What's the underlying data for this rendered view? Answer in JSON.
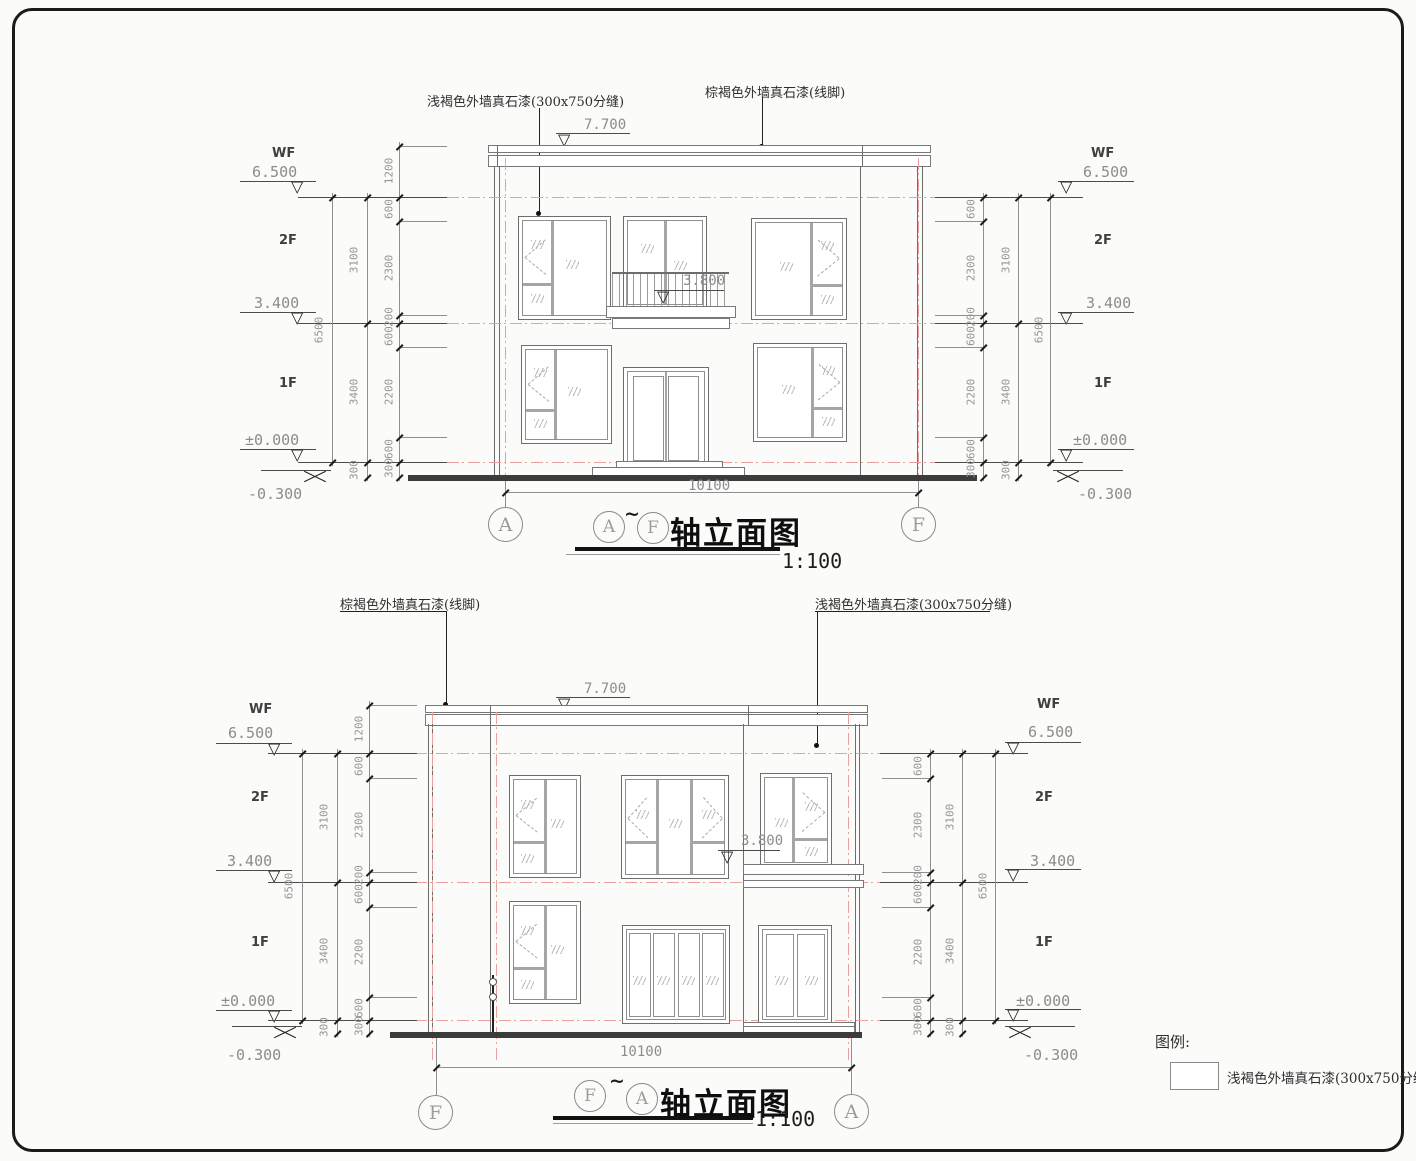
{
  "annotations": {
    "paint_light": "浅褐色外墙真石漆(300x750分缝)",
    "paint_dark": "棕褐色外墙真石漆(线脚)"
  },
  "levels": {
    "l77": "7.700",
    "l65": "6.500",
    "l38": "3.800",
    "l34": "3.400",
    "l00": "±0.000",
    "lm03": "-0.300"
  },
  "floors": {
    "wf": "WF",
    "f2": "2F",
    "f1": "1F"
  },
  "dims": {
    "d10100": "10100",
    "d1200": "1200",
    "d600": "600",
    "d2300": "2300",
    "d200": "200",
    "d2200": "2200",
    "d300": "300",
    "d3100": "3100",
    "d3400": "3400",
    "d6500": "6500"
  },
  "titles": {
    "top": {
      "left_axis": "A",
      "right_axis": "F",
      "t1": "A",
      "tilde": "~",
      "t2": "F",
      "name": "轴立面图",
      "scale": "1:100"
    },
    "bottom": {
      "left_axis": "F",
      "right_axis": "A",
      "t1": "F",
      "tilde": "~",
      "t2": "A",
      "name": "轴立面图",
      "scale": "1:100"
    }
  },
  "legend": {
    "title": "图例:",
    "item1": "浅褐色外墙真石漆(300x750分缝)"
  }
}
